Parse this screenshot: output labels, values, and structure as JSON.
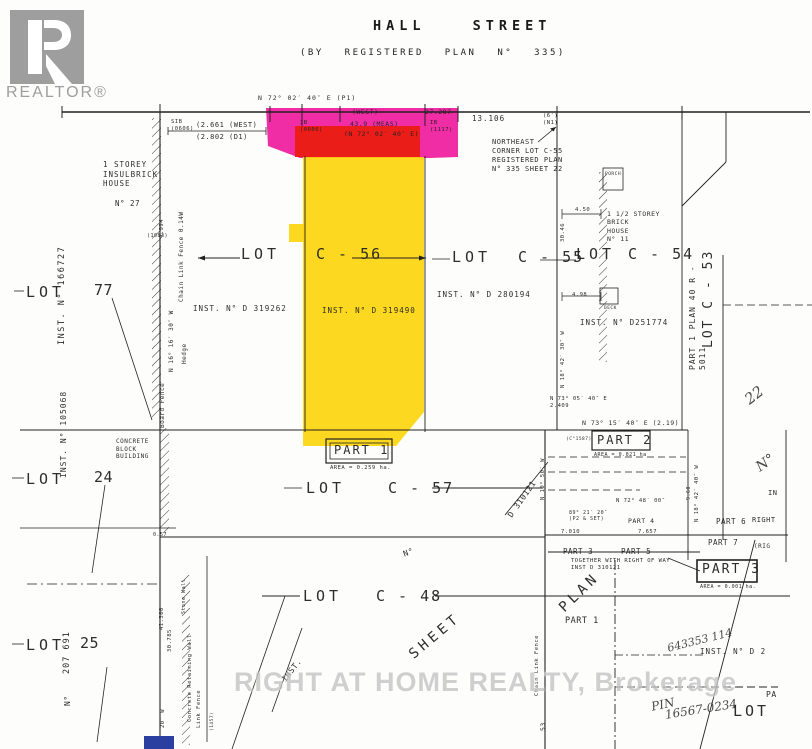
{
  "logo": {
    "brand": "REALTOR®"
  },
  "header": {
    "street": "HALL STREET",
    "plan": "(BY REGISTERED PLAN N° 335)"
  },
  "watermark": {
    "text": "RIGHT AT HOME REALTY, Brokerage"
  },
  "colors": {
    "magenta": "#ee1099",
    "red": "#ea1c0d",
    "yellow": "#fdd408",
    "blue": "#2a3f9f",
    "logo": "#9e9e9e",
    "watermark": "#c4c4c4"
  },
  "annotations": [
    {
      "text": "N 72° 02′ 40″ E   (P1)",
      "x": 258,
      "y": 94,
      "fs": 6.5,
      "ls": 1
    },
    {
      "text": "(WEST)",
      "x": 352,
      "y": 108,
      "fs": 6.5
    },
    {
      "text": "27.287",
      "x": 425,
      "y": 108,
      "fs": 6.5
    },
    {
      "text": "13.106",
      "x": 472,
      "y": 114,
      "fs": 7.5,
      "ls": 1
    },
    {
      "text": "(2.661 (WEST)",
      "x": 196,
      "y": 121,
      "fs": 7
    },
    {
      "text": "(2.802  (D1)",
      "x": 196,
      "y": 133,
      "fs": 7
    },
    {
      "text": "SIB\n(0606)",
      "x": 171,
      "y": 119,
      "fs": 5.5
    },
    {
      "text": "IB\n(0606)",
      "x": 300,
      "y": 120,
      "fs": 5.5
    },
    {
      "text": "43.9 (MEAS)",
      "x": 350,
      "y": 120,
      "fs": 6.5
    },
    {
      "text": "(N 72° 02′ 40″ E)",
      "x": 344,
      "y": 130,
      "fs": 6.5
    },
    {
      "text": "IB\n(1117)",
      "x": 430,
      "y": 120,
      "fs": 5.5
    },
    {
      "text": "(6′)\n(N1)",
      "x": 543,
      "y": 113,
      "fs": 5.5
    },
    {
      "name": "northeast-corner-note",
      "text": "NORTHEAST\nCORNER LOT C-55\nREGISTERED PLAN\nN° 335  SHEET 22",
      "x": 492,
      "y": 138,
      "fs": 7
    },
    {
      "text": "1 STOREY\nINSULBRICK\nHOUSE",
      "x": 103,
      "y": 160,
      "fs": 7.5,
      "ls": 1
    },
    {
      "text": "N° 27",
      "x": 115,
      "y": 199,
      "fs": 7.5
    },
    {
      "name": "inst-166727",
      "text": "INST.  N° 166727",
      "x": 57,
      "y": 345,
      "fs": 8.5,
      "rot": -90,
      "ls": 1.5
    },
    {
      "name": "lot-77-label",
      "text": "LOT",
      "x": 26,
      "y": 283,
      "fs": 15,
      "ls": 4,
      "cls": "big"
    },
    {
      "name": "lot-77-number",
      "text": "77",
      "x": 94,
      "y": 281,
      "fs": 15,
      "cls": "big"
    },
    {
      "text": "Chain Link Fence 0.14W",
      "x": 178,
      "y": 302,
      "fs": 6,
      "rot": -90
    },
    {
      "text": "N 16° 16′ 30″ W",
      "x": 168,
      "y": 372,
      "fs": 6,
      "rot": -90
    },
    {
      "text": "Hedge",
      "x": 181,
      "y": 364,
      "fs": 6,
      "rot": -90
    },
    {
      "text": "4.994",
      "x": 159,
      "y": 238,
      "fs": 5.5,
      "rot": -90
    },
    {
      "text": "(1083)",
      "x": 147,
      "y": 233,
      "fs": 5
    },
    {
      "text": "Board Fence",
      "x": 159,
      "y": 428,
      "fs": 6,
      "rot": -90
    },
    {
      "name": "lot-c56-label",
      "text": "LOT",
      "x": 241,
      "y": 245,
      "fs": 15,
      "ls": 4,
      "cls": "big"
    },
    {
      "name": "lot-c56-number",
      "text": "C - 56",
      "x": 316,
      "y": 245,
      "fs": 15,
      "ls": 2,
      "cls": "big"
    },
    {
      "name": "lot-c55-label",
      "text": "LOT",
      "x": 452,
      "y": 248,
      "fs": 15,
      "ls": 4,
      "cls": "big"
    },
    {
      "name": "lot-c55-number",
      "text": "C - 55",
      "x": 518,
      "y": 248,
      "fs": 15,
      "ls": 2,
      "cls": "big"
    },
    {
      "name": "lot-c54-label",
      "text": "LOT",
      "x": 576,
      "y": 245,
      "fs": 15,
      "ls": 4,
      "cls": "big"
    },
    {
      "name": "lot-c54-number",
      "text": "C - 54",
      "x": 628,
      "y": 245,
      "fs": 15,
      "ls": 2,
      "cls": "big"
    },
    {
      "name": "lot-c53-label",
      "text": "LOT    C - 53",
      "x": 701,
      "y": 348,
      "fs": 13,
      "rot": -90,
      "ls": 2,
      "cls": "big"
    },
    {
      "name": "part1-plan-strip",
      "text": "PART  1   PLAN  40 R -  5011",
      "x": 688,
      "y": 370,
      "fs": 8,
      "rot": -90,
      "ls": 1
    },
    {
      "name": "lot-22-number",
      "text": "22",
      "x": 741,
      "y": 394,
      "fs": 15,
      "rot": -38,
      "cls": "hand"
    },
    {
      "name": "inst-d319262",
      "text": "INST. N° D 319262",
      "x": 193,
      "y": 304,
      "fs": 7.5,
      "ls": 1
    },
    {
      "name": "inst-d319490",
      "text": "INST. N° D 319490",
      "x": 322,
      "y": 306,
      "fs": 7.5,
      "ls": 1
    },
    {
      "name": "inst-d280194",
      "text": "INST.   N° D 280194",
      "x": 437,
      "y": 290,
      "fs": 7.5,
      "ls": 1
    },
    {
      "name": "inst-d251774",
      "text": "INST.  N° D251774",
      "x": 580,
      "y": 318,
      "fs": 7.5,
      "ls": 1
    },
    {
      "text": "PORCH",
      "x": 605,
      "y": 172,
      "fs": 4.5
    },
    {
      "text": "4.50",
      "x": 575,
      "y": 207,
      "fs": 5.5
    },
    {
      "text": "30.46",
      "x": 560,
      "y": 242,
      "fs": 5.5,
      "rot": -90
    },
    {
      "text": "1 1/2 STOREY\nBRICK\nHOUSE\nN° 11",
      "x": 607,
      "y": 210,
      "fs": 6.5
    },
    {
      "text": "DECK",
      "x": 604,
      "y": 306,
      "fs": 4.5
    },
    {
      "text": "4.98",
      "x": 572,
      "y": 292,
      "fs": 5.5
    },
    {
      "text": "N 18° 42′ 30″ W",
      "x": 560,
      "y": 388,
      "fs": 5.5,
      "rot": -90
    },
    {
      "name": "part-1-label",
      "text": "PART 1",
      "x": 334,
      "y": 443,
      "fs": 12,
      "ls": 2,
      "cls": "big"
    },
    {
      "name": "part-1-area",
      "text": "AREA = 0.259 ha.",
      "x": 330,
      "y": 465,
      "fs": 5.5
    },
    {
      "name": "lot-c57-label",
      "text": "LOT",
      "x": 306,
      "y": 479,
      "fs": 15,
      "ls": 4,
      "cls": "big"
    },
    {
      "name": "lot-c57-number",
      "text": "C - 57",
      "x": 388,
      "y": 479,
      "fs": 15,
      "ls": 2,
      "cls": "big"
    },
    {
      "text": "D 310121",
      "x": 506,
      "y": 514,
      "fs": 8,
      "rot": -55
    },
    {
      "text": "N°",
      "x": 402,
      "y": 550,
      "fs": 8,
      "rot": -20
    },
    {
      "text": "N 73° 15′ 40″ E   (2.19)",
      "x": 582,
      "y": 419,
      "fs": 6.5
    },
    {
      "text": "N 73° 05′ 40″ E\n2.409",
      "x": 550,
      "y": 396,
      "fs": 5.5
    },
    {
      "text": "(C°1587)",
      "x": 566,
      "y": 437,
      "fs": 4.5
    },
    {
      "name": "part-2-label",
      "text": "PART 2",
      "x": 597,
      "y": 433,
      "fs": 12,
      "ls": 2,
      "cls": "big"
    },
    {
      "name": "part-2-area",
      "text": "AREA = 0.021 ha",
      "x": 594,
      "y": 452,
      "fs": 5
    },
    {
      "text": "N 10° 50′ W",
      "x": 540,
      "y": 500,
      "fs": 5.5,
      "rot": -90
    },
    {
      "text": "N 72° 48′ 00″",
      "x": 616,
      "y": 498,
      "fs": 5.5
    },
    {
      "text": "89° 21′ 20″\n(P2 & SET)",
      "x": 569,
      "y": 510,
      "fs": 5
    },
    {
      "text": "PART 4",
      "x": 628,
      "y": 517,
      "fs": 6.5
    },
    {
      "text": "7.010",
      "x": 561,
      "y": 529,
      "fs": 5.5
    },
    {
      "text": "7.657",
      "x": 638,
      "y": 529,
      "fs": 5.5
    },
    {
      "name": "part-3-small-label",
      "text": "PART 3",
      "x": 563,
      "y": 547,
      "fs": 7.5
    },
    {
      "name": "part-5-label",
      "text": "PART 5",
      "x": 621,
      "y": 547,
      "fs": 7.5
    },
    {
      "name": "part-6-label",
      "text": "PART 6",
      "x": 716,
      "y": 517,
      "fs": 7.5
    },
    {
      "text": "RIGHT",
      "x": 752,
      "y": 516,
      "fs": 7
    },
    {
      "name": "part-7-label",
      "text": "PART 7",
      "x": 708,
      "y": 538,
      "fs": 7.5
    },
    {
      "text": "(RIG",
      "x": 754,
      "y": 543,
      "fs": 6
    },
    {
      "text": "IN",
      "x": 768,
      "y": 489,
      "fs": 7
    },
    {
      "text": "TOGETHER  WITH  RIGHT OF WAY\nINST  D 310121",
      "x": 571,
      "y": 558,
      "fs": 5.5
    },
    {
      "name": "part-3-label",
      "text": "PART 3",
      "x": 702,
      "y": 562,
      "fs": 13,
      "ls": 2,
      "cls": "big"
    },
    {
      "name": "part-3-area",
      "text": "AREA = 0.001 ha.",
      "x": 700,
      "y": 584,
      "fs": 5
    },
    {
      "name": "plan-diagonal",
      "text": "PLAN",
      "x": 556,
      "y": 604,
      "fs": 14,
      "rot": -44,
      "ls": 4,
      "cls": "big"
    },
    {
      "text": "PART 1",
      "x": 565,
      "y": 616,
      "fs": 8.5
    },
    {
      "text": "N°",
      "x": 753,
      "y": 462,
      "fs": 14,
      "rot": -35,
      "cls": "hand"
    },
    {
      "text": "N 18° 42′ 40″ W",
      "x": 694,
      "y": 522,
      "fs": 5.5,
      "rot": -90
    },
    {
      "text": "9.60",
      "x": 686,
      "y": 500,
      "fs": 5,
      "rot": -90
    },
    {
      "name": "lot-c48-label",
      "text": "LOT",
      "x": 303,
      "y": 587,
      "fs": 15,
      "ls": 4,
      "cls": "big"
    },
    {
      "name": "lot-c48-number",
      "text": "C - 48",
      "x": 376,
      "y": 587,
      "fs": 15,
      "ls": 2,
      "cls": "big"
    },
    {
      "name": "sheet-diagonal",
      "text": "SHEET",
      "x": 406,
      "y": 650,
      "fs": 14,
      "rot": -40,
      "ls": 4,
      "cls": "big"
    },
    {
      "name": "lot-24-label",
      "text": "LOT",
      "x": 26,
      "y": 470,
      "fs": 15,
      "ls": 4,
      "cls": "big"
    },
    {
      "name": "lot-24-number",
      "text": "24",
      "x": 94,
      "y": 468,
      "fs": 15,
      "cls": "big"
    },
    {
      "name": "inst-105068",
      "text": "INST. N° 105068",
      "x": 59,
      "y": 478,
      "fs": 8,
      "rot": -90,
      "ls": 1
    },
    {
      "text": "CONCRETE\nBLOCK\nBUILDING",
      "x": 116,
      "y": 438,
      "fs": 6
    },
    {
      "text": "0.57",
      "x": 153,
      "y": 532,
      "fs": 5
    },
    {
      "name": "lot-25-label",
      "text": "LOT",
      "x": 26,
      "y": 636,
      "fs": 15,
      "ls": 4,
      "cls": "big"
    },
    {
      "name": "lot-25-number",
      "text": "25",
      "x": 80,
      "y": 634,
      "fs": 15,
      "cls": "big"
    },
    {
      "name": "inst-207691",
      "text": "207 691",
      "x": 62,
      "y": 674,
      "fs": 8.5,
      "rot": -90,
      "ls": 1
    },
    {
      "text": "N°",
      "x": 63,
      "y": 706,
      "fs": 8,
      "rot": -90
    },
    {
      "text": "41.300",
      "x": 159,
      "y": 630,
      "fs": 5.5,
      "rot": -90
    },
    {
      "text": "30.785",
      "x": 167,
      "y": 652,
      "fs": 5.5,
      "rot": -90
    },
    {
      "text": "Stone Wall",
      "x": 181,
      "y": 614,
      "fs": 5,
      "rot": -90
    },
    {
      "text": "Concrete Retaining Wall",
      "x": 187,
      "y": 722,
      "fs": 5.5,
      "rot": -90
    },
    {
      "text": "Link  Fence",
      "x": 196,
      "y": 728,
      "fs": 5.5,
      "rot": -90
    },
    {
      "text": "20′ W",
      "x": 160,
      "y": 728,
      "fs": 5.5,
      "rot": -90
    },
    {
      "text": "(1457)",
      "x": 210,
      "y": 731,
      "fs": 4.5,
      "rot": -90
    },
    {
      "text": "INST.",
      "x": 280,
      "y": 678,
      "fs": 8,
      "rot": -52
    },
    {
      "text": "Chain Link Fence",
      "x": 534,
      "y": 696,
      "fs": 5.5,
      "rot": -90
    },
    {
      "text": "53",
      "x": 539,
      "y": 731,
      "fs": 6.5,
      "rot": -90
    },
    {
      "name": "handwritten-643353",
      "text": "643353 114",
      "x": 666,
      "y": 642,
      "fs": 11,
      "rot": -14,
      "cls": "hand"
    },
    {
      "name": "inst-d2",
      "text": "INST.    N° D 2",
      "x": 700,
      "y": 647,
      "fs": 7.5,
      "ls": 1
    },
    {
      "name": "handwritten-pin",
      "text": "PIN",
      "x": 650,
      "y": 700,
      "fs": 12,
      "rot": -12,
      "cls": "hand"
    },
    {
      "name": "handwritten-pin-number",
      "text": "16567-0234",
      "x": 664,
      "y": 708,
      "fs": 12,
      "rot": -9,
      "cls": "hand"
    },
    {
      "text": "PA",
      "x": 766,
      "y": 690,
      "fs": 8
    },
    {
      "name": "lot-bottom-right",
      "text": "LOT",
      "x": 733,
      "y": 702,
      "fs": 15,
      "ls": 3,
      "cls": "big"
    }
  ]
}
